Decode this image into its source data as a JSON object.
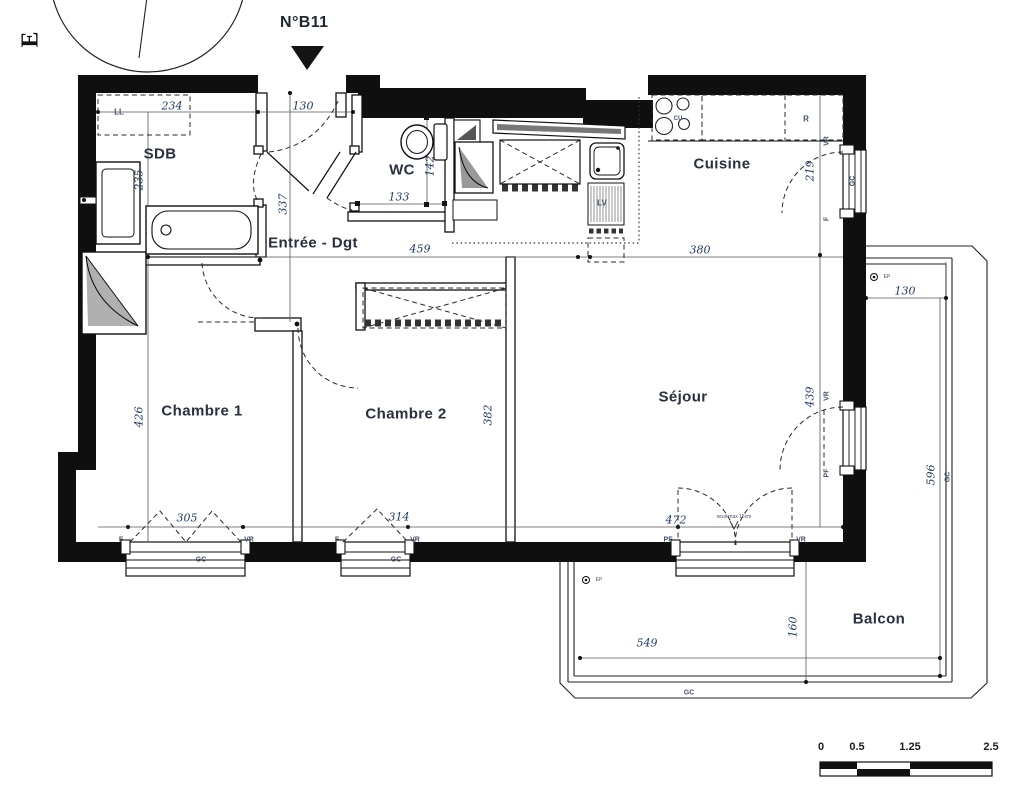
{
  "unit": {
    "number": "N°B11",
    "orientation": "E"
  },
  "rooms": {
    "bathroom": "SDB",
    "wc": "WC",
    "kitchen": "Cuisine",
    "entry": "Entrée - Dgt",
    "bedroom1": "Chambre 1",
    "bedroom2": "Chambre 2",
    "living": "Séjour",
    "balcony": "Balcon"
  },
  "dimensions_cm": {
    "sdb_width": "234",
    "entry_door_width": "130",
    "sdb_depth": "235",
    "entry_depth": "337",
    "wc_width": "133",
    "wc_depth": "142",
    "entry_length": "459",
    "kitchen_width": "380",
    "kitchen_depth": "219",
    "bedroom1_depth": "426",
    "bedroom2_depth": "382",
    "living_depth": "439",
    "bedroom1_window": "305",
    "bedroom2_window": "314",
    "living_width": "472",
    "balcony_top_width": "130",
    "balcony_length": "596",
    "balcony_depth": "160",
    "balcony_width": "549"
  },
  "labels": {
    "washing_machine": "LL",
    "cooktop": "CU",
    "fridge": "R",
    "dishwasher": "LV",
    "window": "F",
    "roller_shutter": "VR",
    "french_window": "PF",
    "railing": "GC",
    "rain_pipe": "EP",
    "threshold_note": "seuil max 15cm"
  },
  "scale_bar": {
    "ticks": [
      "0",
      "0.5",
      "1.25",
      "2.5"
    ]
  },
  "colors": {
    "wall": "#0f0f0f",
    "dim_text": "#223c66",
    "room_text": "#27303c"
  }
}
